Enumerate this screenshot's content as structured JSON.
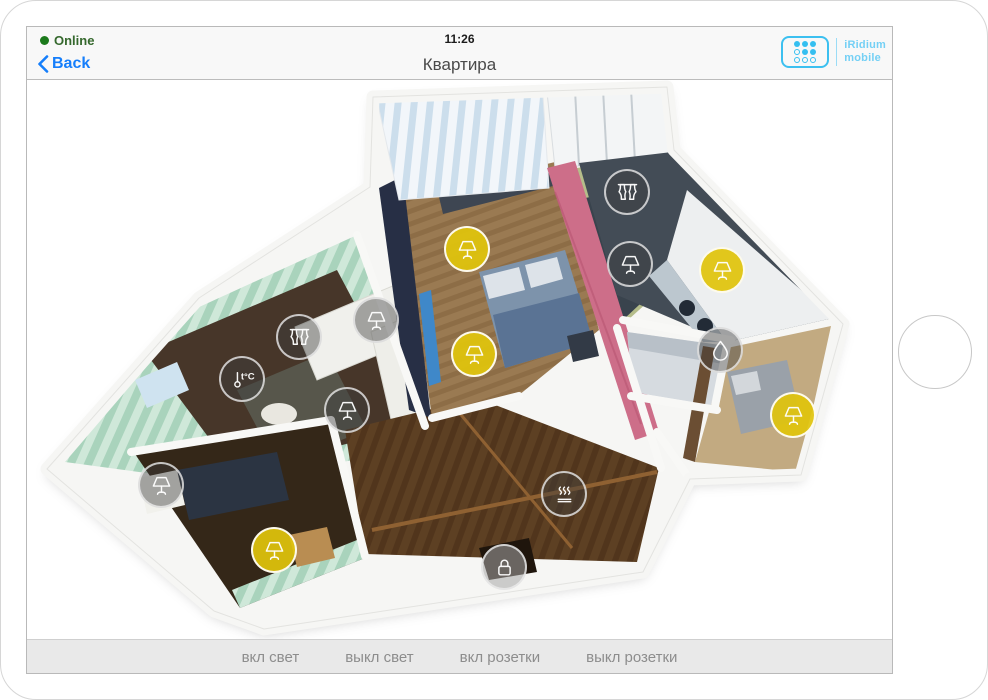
{
  "status_bar": {
    "online_label": "Online",
    "time": "11:26"
  },
  "nav_bar": {
    "back_label": "Back",
    "title": "Квартира",
    "logo": {
      "line1": "iRidium",
      "line2": "mobile",
      "dots": [
        1,
        1,
        1,
        0,
        1,
        1,
        0,
        0,
        0
      ]
    }
  },
  "toolbar": {
    "buttons": [
      {
        "label": "вкл свет"
      },
      {
        "label": "выкл свет"
      },
      {
        "label": "вкл розетки"
      },
      {
        "label": "выкл розетки"
      }
    ]
  },
  "colors": {
    "accent_blue": "#157efb",
    "logo_blue": "#3cc0f0",
    "on_yellow": "#e0c40c",
    "off_gray": "rgba(62,62,62,0.44)",
    "online_green": "#1c7a1c"
  },
  "floorplan": {
    "devices": [
      {
        "id": "light-bedroom-desk",
        "type": "lamp",
        "state": "on",
        "x": 440,
        "y": 169
      },
      {
        "id": "light-bedroom-bed",
        "type": "lamp",
        "state": "on",
        "x": 447,
        "y": 274
      },
      {
        "id": "curtain-child-room",
        "type": "curtain",
        "state": "off",
        "x": 600,
        "y": 112
      },
      {
        "id": "light-child-room",
        "type": "lamp",
        "state": "off",
        "x": 603,
        "y": 184
      },
      {
        "id": "light-kitchen",
        "type": "lamp",
        "state": "on",
        "x": 695,
        "y": 190
      },
      {
        "id": "water-bathroom",
        "type": "drop",
        "state": "off",
        "x": 693,
        "y": 270
      },
      {
        "id": "light-guest-room",
        "type": "lamp",
        "state": "on",
        "x": 766,
        "y": 335
      },
      {
        "id": "curtain-living-room",
        "type": "curtain",
        "state": "off",
        "x": 272,
        "y": 257
      },
      {
        "id": "light-living-room-1",
        "type": "lamp",
        "state": "off",
        "x": 349,
        "y": 240
      },
      {
        "id": "thermostat-living-room",
        "type": "thermo",
        "state": "off",
        "x": 215,
        "y": 299
      },
      {
        "id": "light-living-room-2",
        "type": "lamp",
        "state": "off",
        "x": 320,
        "y": 330
      },
      {
        "id": "light-office-1",
        "type": "lamp",
        "state": "off",
        "x": 134,
        "y": 405
      },
      {
        "id": "light-office-2",
        "type": "lamp",
        "state": "on",
        "x": 247,
        "y": 470
      },
      {
        "id": "floor-heating-hall",
        "type": "floorheat",
        "state": "off",
        "x": 537,
        "y": 414
      },
      {
        "id": "lock-entrance",
        "type": "lock",
        "state": "off",
        "x": 477,
        "y": 487
      }
    ]
  }
}
